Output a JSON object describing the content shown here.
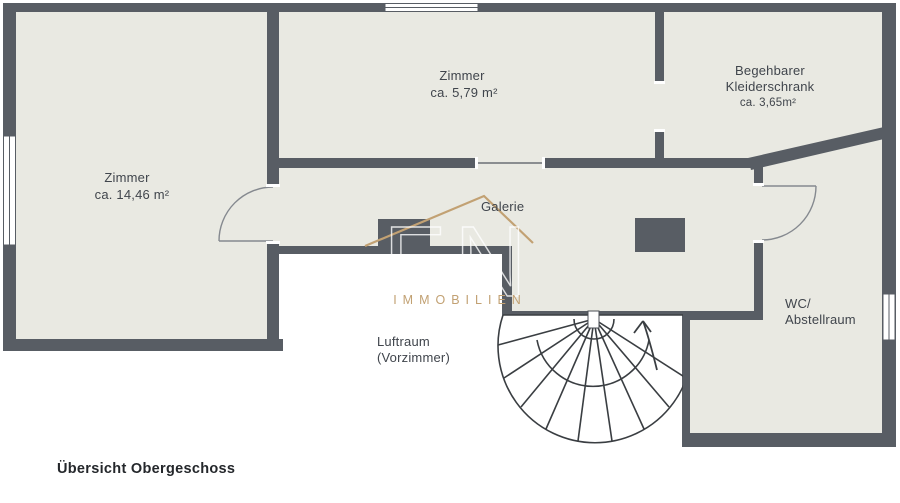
{
  "plan": {
    "title": "Übersicht Obergeschoss",
    "rooms": {
      "zimmer_top": {
        "name": "Zimmer",
        "area": "ca. 5,79 m²"
      },
      "kleiderschrank": {
        "line1": "Begehbarer",
        "line2": "Kleiderschrank",
        "area": "ca. 3,65m²"
      },
      "zimmer_left": {
        "name": "Zimmer",
        "area": "ca. 14,46 m²"
      },
      "galerie": {
        "name": "Galerie"
      },
      "wc": {
        "line1": "WC/",
        "line2": "Abstellraum"
      },
      "luftraum": {
        "line1": "Luftraum",
        "line2": "(Vorzimmer)"
      }
    },
    "watermark": {
      "logo": "FN",
      "text": "IMMOBILIEN"
    },
    "colors": {
      "wall": "#585d64",
      "floor": "#e9e9e2",
      "gold": "#c2a173",
      "label": "#40454c",
      "title": "#24272b",
      "background": "#ffffff"
    }
  }
}
